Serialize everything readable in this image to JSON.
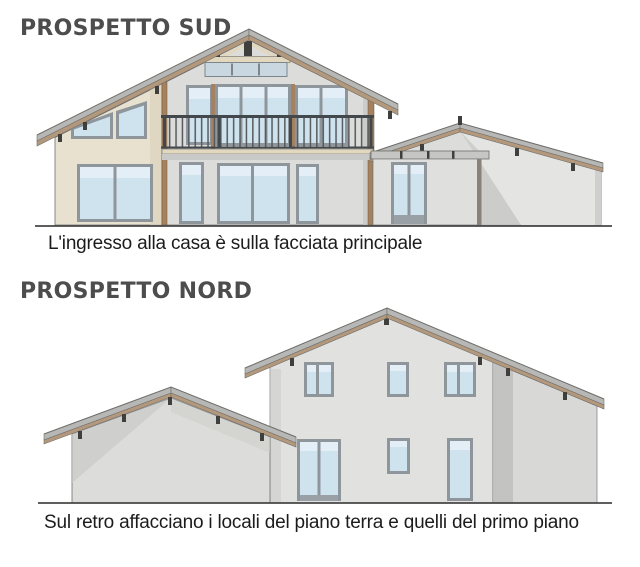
{
  "figures": [
    {
      "id": "sud",
      "title": "PROSPETTO SUD",
      "caption": "L'ingresso alla casa è sulla facciata principale"
    },
    {
      "id": "nord",
      "title": "PROSPETTO NORD",
      "caption": "Sul retro affacciano i locali del piano terra e quelli del primo piano"
    }
  ],
  "palette": {
    "wall-gray": "#dcdcda",
    "wall-beige": "#e8e1d0",
    "wall-shadow": "#c7c7c5",
    "roof-cap": "#b7b7b5",
    "fascia-brown": "#b3987c",
    "timber": "#a5825f",
    "window-frame": "#8f969b",
    "glass": "#cfe3ef",
    "glass-light": "#e4eef6",
    "railing": "#43484c",
    "truss-beige": "#e2d8c0",
    "detail-dark": "#3f3f3d",
    "outline": "#6f6f6d",
    "ground-line": "#474747",
    "title-color": "#4d4d4d",
    "caption-color": "#1c1c1c"
  }
}
